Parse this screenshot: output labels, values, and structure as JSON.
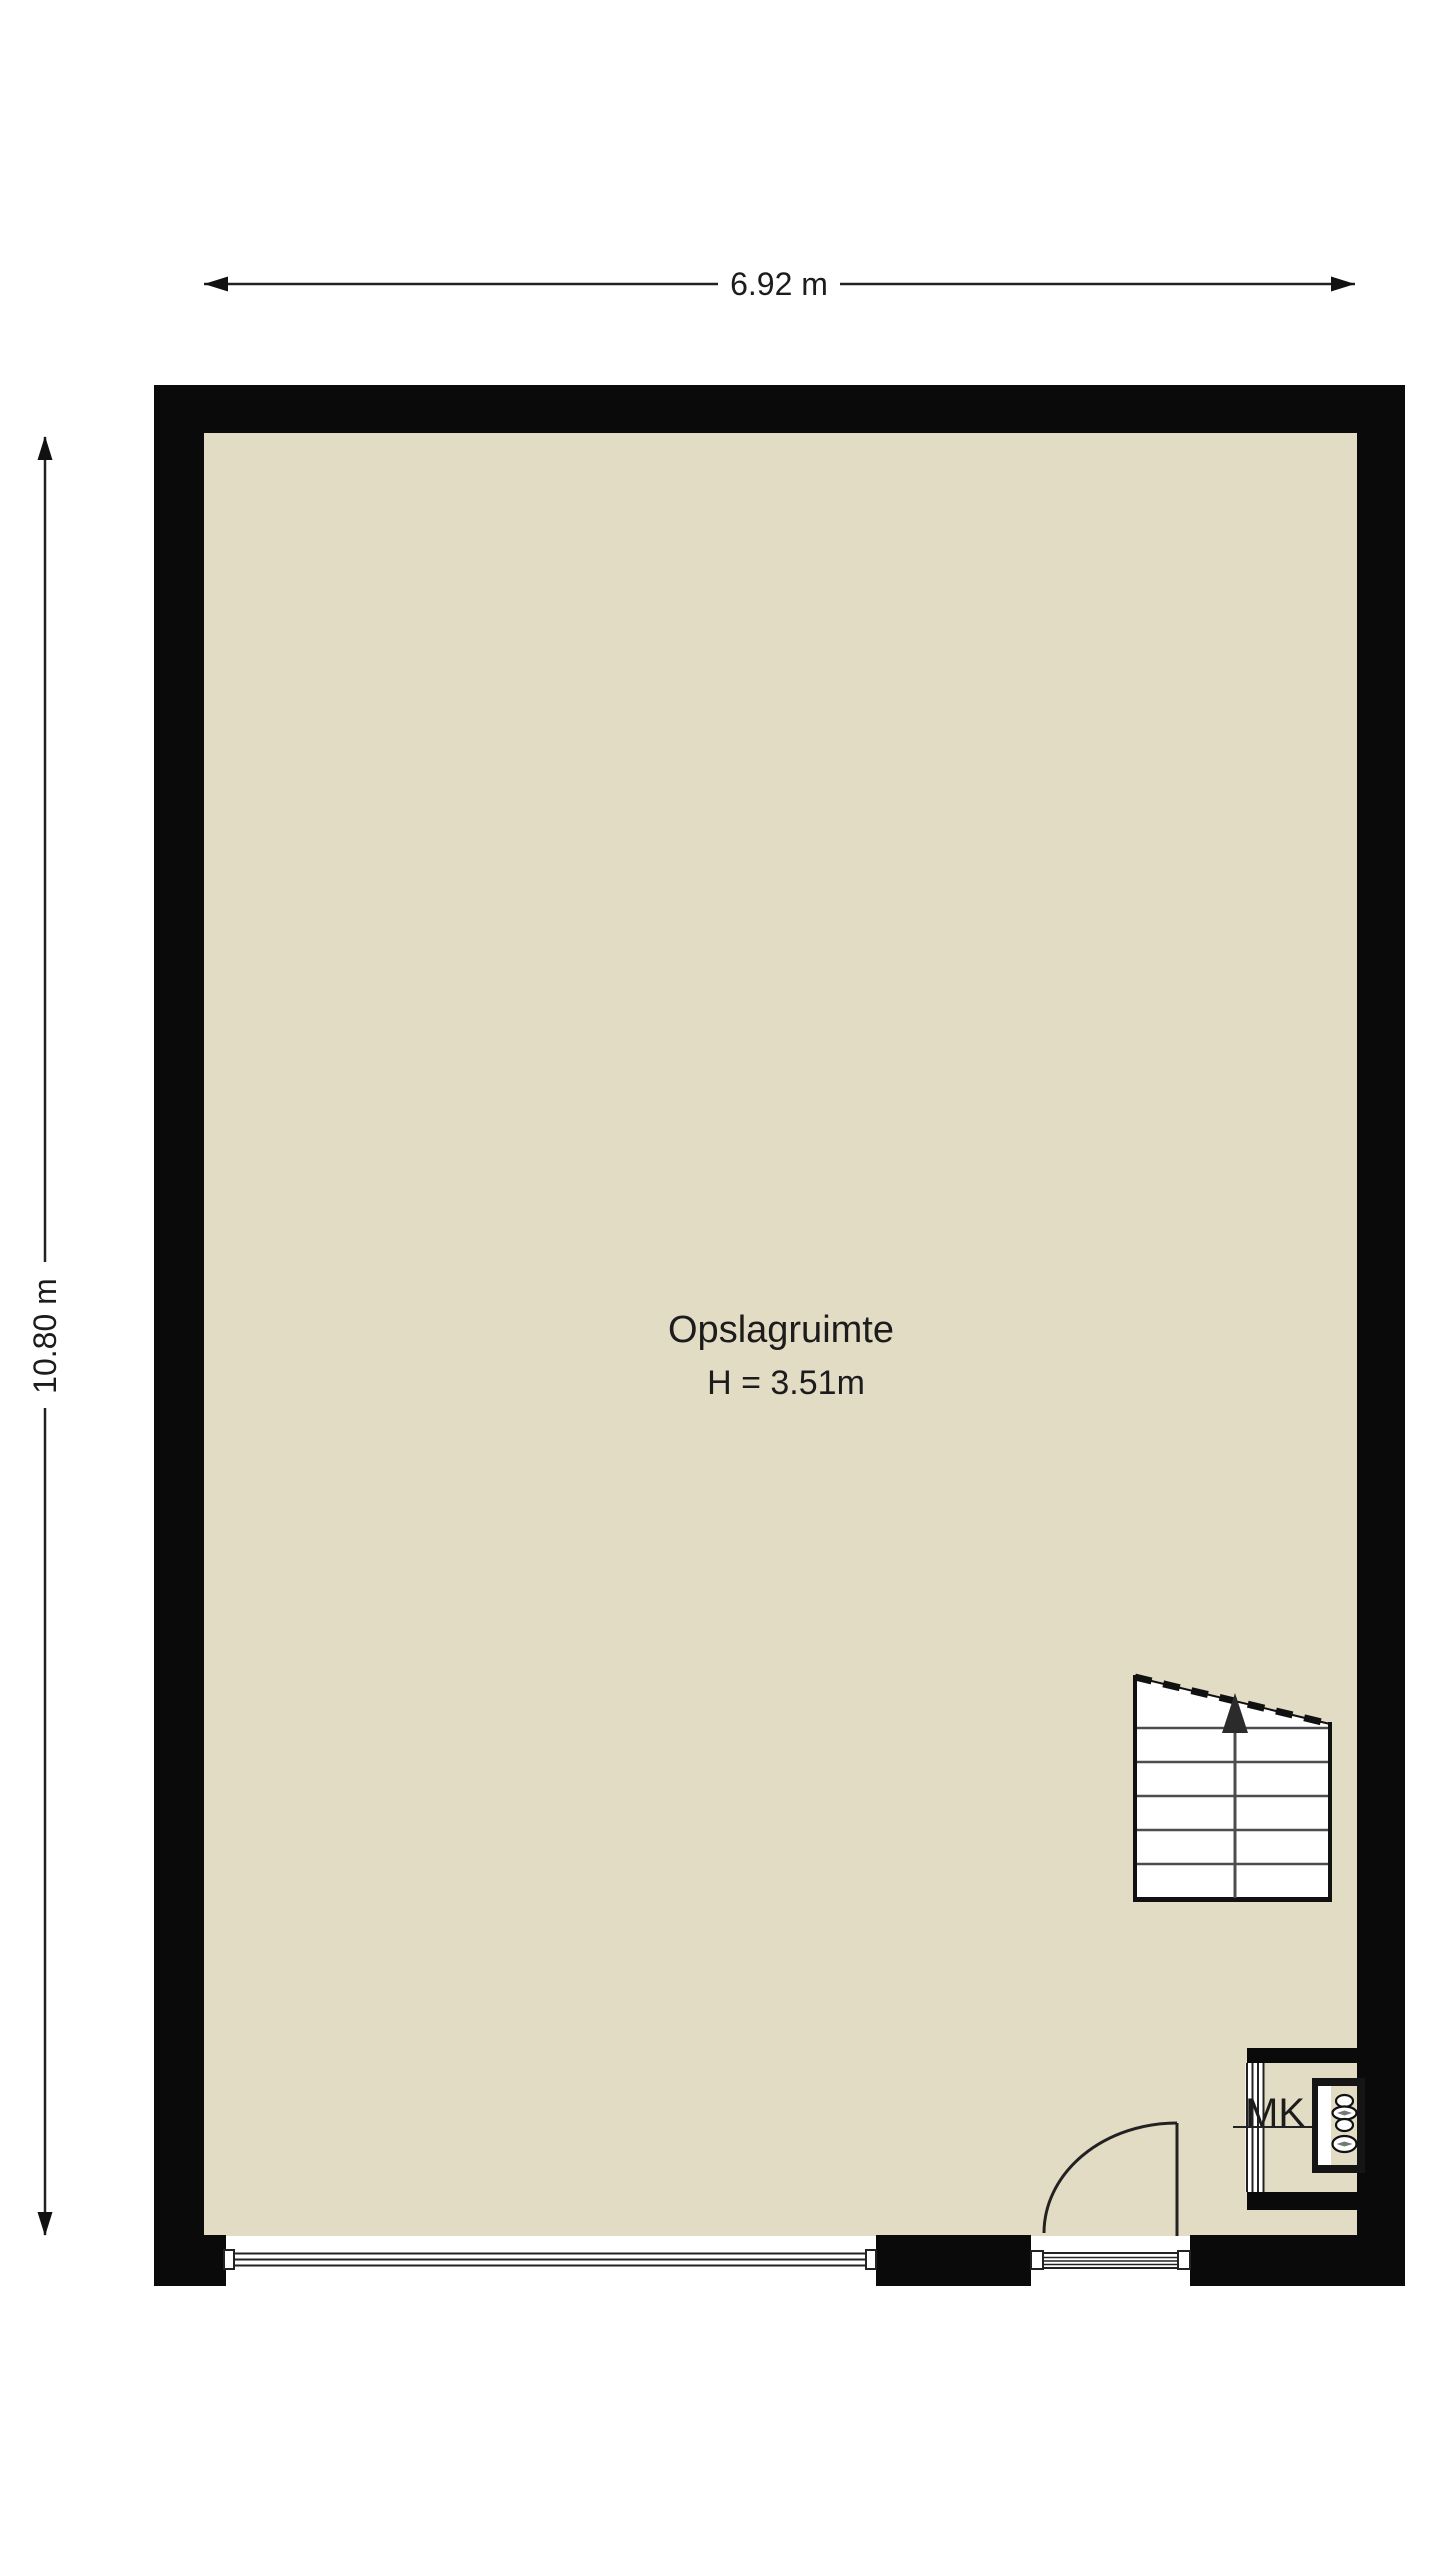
{
  "floor_plan": {
    "dimensions": {
      "width": "6.92 m",
      "height": "10.80 m"
    },
    "room": {
      "name": "Opslagruimte",
      "ceiling_height": "H = 3.51m"
    },
    "meter_closet": {
      "label": "MK"
    },
    "icons": {
      "staircase": "staircase-up-arrow-icon",
      "door": "door-swing-arc-icon",
      "meter": "electric-meter-symbol-icon",
      "windows": "window-glazing-lines-icon"
    },
    "colors": {
      "background": "#ffffff",
      "floor": "#e3dcc5",
      "wall": "#0a0a0a",
      "line": "#222222",
      "steps": "#4d4d4d"
    }
  }
}
